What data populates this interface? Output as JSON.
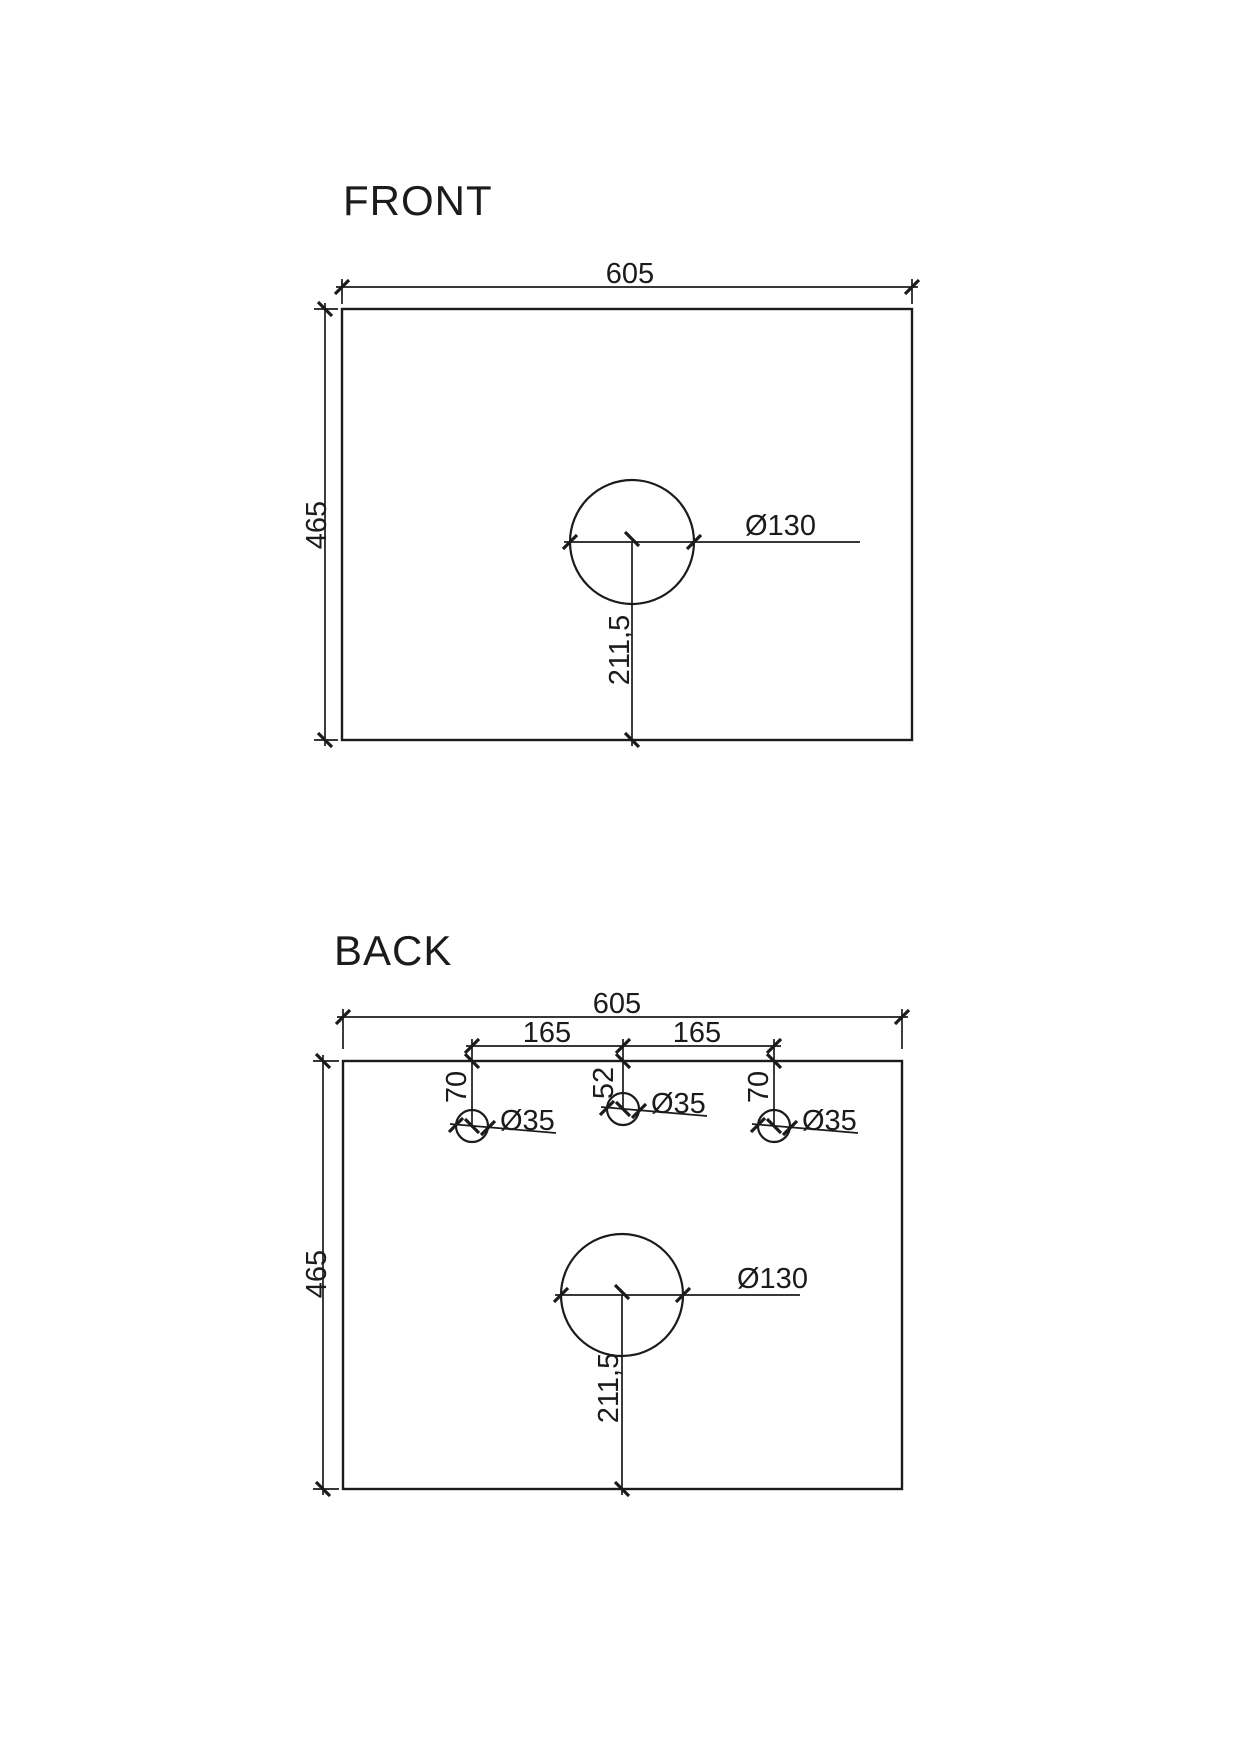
{
  "drawing": {
    "background_color": "#ffffff",
    "line_color": "#1b1b1b",
    "views": {
      "front": {
        "title": "FRONT",
        "width_dim": "605",
        "height_dim": "465",
        "hole": {
          "diameter_dim": "Ø130",
          "offset_from_bottom_dim": "211,5"
        }
      },
      "back": {
        "title": "BACK",
        "width_dim": "605",
        "height_dim": "465",
        "spacing_dims": [
          "165",
          "165"
        ],
        "small_holes": [
          {
            "diameter_dim": "Ø35",
            "offset_from_top_dim": "70"
          },
          {
            "diameter_dim": "Ø35",
            "offset_from_top_dim": "52"
          },
          {
            "diameter_dim": "Ø35",
            "offset_from_top_dim": "70"
          }
        ],
        "hole": {
          "diameter_dim": "Ø130",
          "offset_from_bottom_dim": "211,5"
        }
      }
    }
  }
}
